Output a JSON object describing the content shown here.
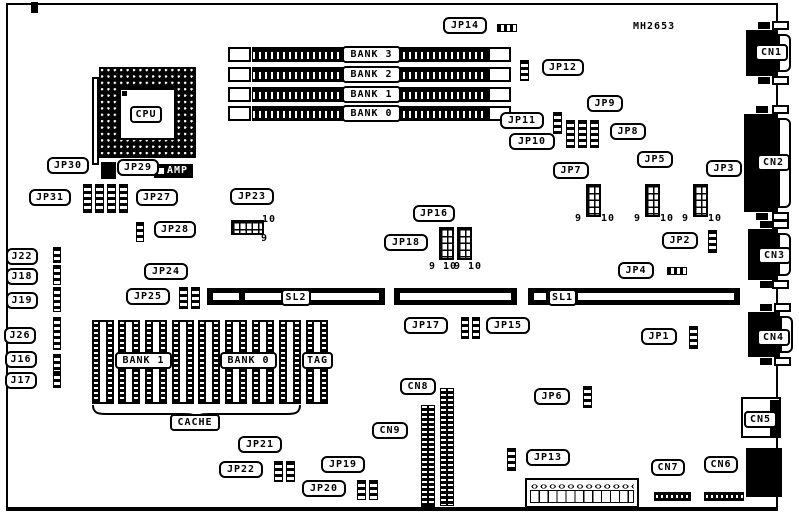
{
  "colors": {
    "ink": "#000000",
    "paper": "#ffffff"
  },
  "board": {
    "x": 6,
    "y": 3,
    "w": 772,
    "h": 508
  },
  "part_label": {
    "text": "MH2653",
    "x": 633,
    "y": 21
  },
  "amp": {
    "text": "AMP",
    "x": 154,
    "y": 164,
    "w": 39,
    "h": 14
  },
  "callouts": [
    {
      "text": "JP14",
      "x": 443,
      "y": 17,
      "w": 44,
      "dir": "right"
    },
    {
      "text": "JP12",
      "x": 542,
      "y": 59,
      "w": 42,
      "dir": "left"
    },
    {
      "text": "JP11",
      "x": 500,
      "y": 112,
      "w": 44,
      "dir": "right"
    },
    {
      "text": "JP9",
      "x": 587,
      "y": 95,
      "w": 36,
      "dir": "down-left"
    },
    {
      "text": "JP10",
      "x": 509,
      "y": 133,
      "w": 46,
      "dir": "right"
    },
    {
      "text": "JP8",
      "x": 610,
      "y": 123,
      "w": 36,
      "dir": "left"
    },
    {
      "text": "JP7",
      "x": 553,
      "y": 162,
      "w": 36,
      "dir": "down-right"
    },
    {
      "text": "JP5",
      "x": 637,
      "y": 151,
      "w": 36,
      "dir": "down"
    },
    {
      "text": "JP3",
      "x": 706,
      "y": 160,
      "w": 36,
      "dir": "down-left"
    },
    {
      "text": "JP2",
      "x": 662,
      "y": 232,
      "w": 36,
      "dir": "right"
    },
    {
      "text": "JP4",
      "x": 618,
      "y": 262,
      "w": 36,
      "dir": "right"
    },
    {
      "text": "JP23",
      "x": 230,
      "y": 188,
      "w": 44,
      "dir": "down"
    },
    {
      "text": "JP16",
      "x": 413,
      "y": 205,
      "w": 42,
      "dir": "down-right"
    },
    {
      "text": "JP18",
      "x": 384,
      "y": 234,
      "w": 44,
      "dir": "right"
    },
    {
      "text": "JP30",
      "x": 47,
      "y": 157,
      "w": 42,
      "dir": "down-right"
    },
    {
      "text": "JP29",
      "x": 117,
      "y": 159,
      "w": 42,
      "dir": "down-left"
    },
    {
      "text": "JP31",
      "x": 29,
      "y": 189,
      "w": 42,
      "dir": "right"
    },
    {
      "text": "JP27",
      "x": 136,
      "y": 189,
      "w": 42,
      "dir": "left"
    },
    {
      "text": "JP28",
      "x": 154,
      "y": 221,
      "w": 42,
      "dir": "left"
    },
    {
      "text": "J22",
      "x": 6,
      "y": 248,
      "w": 32,
      "dir": "right"
    },
    {
      "text": "J18",
      "x": 6,
      "y": 268,
      "w": 32,
      "dir": "right"
    },
    {
      "text": "J19",
      "x": 6,
      "y": 292,
      "w": 32,
      "dir": "right"
    },
    {
      "text": "J26",
      "x": 4,
      "y": 327,
      "w": 32,
      "dir": "right"
    },
    {
      "text": "J16",
      "x": 5,
      "y": 351,
      "w": 32,
      "dir": "right"
    },
    {
      "text": "J17",
      "x": 5,
      "y": 372,
      "w": 32,
      "dir": "right"
    },
    {
      "text": "JP24",
      "x": 144,
      "y": 263,
      "w": 44,
      "dir": "down-right"
    },
    {
      "text": "JP25",
      "x": 126,
      "y": 288,
      "w": 44,
      "dir": "right"
    },
    {
      "text": "JP17",
      "x": 404,
      "y": 317,
      "w": 44,
      "dir": "right"
    },
    {
      "text": "JP15",
      "x": 486,
      "y": 317,
      "w": 44,
      "dir": "left"
    },
    {
      "text": "JP1",
      "x": 641,
      "y": 328,
      "w": 36,
      "dir": "right"
    },
    {
      "text": "JP21",
      "x": 238,
      "y": 436,
      "w": 44,
      "dir": "down-right"
    },
    {
      "text": "JP22",
      "x": 219,
      "y": 461,
      "w": 44,
      "dir": "right"
    },
    {
      "text": "JP19",
      "x": 321,
      "y": 456,
      "w": 44,
      "dir": "down-right"
    },
    {
      "text": "JP20",
      "x": 302,
      "y": 480,
      "w": 44,
      "dir": "right"
    },
    {
      "text": "JP6",
      "x": 534,
      "y": 388,
      "w": 36,
      "dir": "right"
    },
    {
      "text": "JP13",
      "x": 526,
      "y": 449,
      "w": 44,
      "dir": "left"
    },
    {
      "text": "CN8",
      "x": 400,
      "y": 378,
      "w": 36,
      "dir": "down-right"
    },
    {
      "text": "CN9",
      "x": 372,
      "y": 422,
      "w": 36,
      "dir": "right"
    },
    {
      "text": "CN7",
      "x": 651,
      "y": 459,
      "w": 34,
      "dir": "down"
    },
    {
      "text": "CN6",
      "x": 704,
      "y": 456,
      "w": 34,
      "dir": "down"
    }
  ],
  "plates": [
    {
      "text": "CPU",
      "x": 130,
      "y": 106,
      "w": 32
    },
    {
      "text": "BANK 3",
      "x": 342,
      "y": 46,
      "w": 59
    },
    {
      "text": "BANK 2",
      "x": 342,
      "y": 66,
      "w": 59
    },
    {
      "text": "BANK 1",
      "x": 342,
      "y": 86,
      "w": 59
    },
    {
      "text": "BANK 0",
      "x": 342,
      "y": 105,
      "w": 59
    },
    {
      "text": "SL2",
      "x": 281,
      "y": 289,
      "w": 30
    },
    {
      "text": "SL1",
      "x": 548,
      "y": 289,
      "w": 29
    },
    {
      "text": "BANK 1",
      "x": 115,
      "y": 352,
      "w": 57
    },
    {
      "text": "BANK 0",
      "x": 220,
      "y": 352,
      "w": 57
    },
    {
      "text": "TAG",
      "x": 302,
      "y": 352,
      "w": 31
    },
    {
      "text": "CACHE",
      "x": 170,
      "y": 414,
      "w": 50
    },
    {
      "text": "CN1",
      "x": 755,
      "y": 44,
      "w": 33
    },
    {
      "text": "CN2",
      "x": 757,
      "y": 154,
      "w": 33
    },
    {
      "text": "CN3",
      "x": 758,
      "y": 247,
      "w": 33
    },
    {
      "text": "CN4",
      "x": 757,
      "y": 329,
      "w": 33
    },
    {
      "text": "CN5",
      "x": 744,
      "y": 411,
      "w": 33
    }
  ],
  "pin_labels": [
    {
      "text": "10",
      "x": 262,
      "y": 214
    },
    {
      "text": "9",
      "x": 261,
      "y": 233
    },
    {
      "text": "9 10",
      "x": 429,
      "y": 261
    },
    {
      "text": "9 10",
      "x": 454,
      "y": 261
    },
    {
      "text": "9",
      "x": 575,
      "y": 213
    },
    {
      "text": "10",
      "x": 601,
      "y": 213
    },
    {
      "text": "9",
      "x": 634,
      "y": 213
    },
    {
      "text": "10",
      "x": 660,
      "y": 213
    },
    {
      "text": "9",
      "x": 682,
      "y": 213
    },
    {
      "text": "10",
      "x": 708,
      "y": 213
    }
  ],
  "jumpers": [
    {
      "id": "jp14-jumper",
      "x": 497,
      "y": 24,
      "w": 20,
      "h": 8,
      "o": "h"
    },
    {
      "id": "jp12-jumper",
      "x": 520,
      "y": 60,
      "w": 9,
      "h": 21,
      "o": "v"
    },
    {
      "id": "jp11-jumper",
      "x": 553,
      "y": 112,
      "w": 9,
      "h": 22,
      "o": "v"
    },
    {
      "id": "jp10-jumper",
      "x": 566,
      "y": 120,
      "w": 9,
      "h": 28,
      "o": "v"
    },
    {
      "id": "jp9-jumper",
      "x": 578,
      "y": 120,
      "w": 9,
      "h": 28,
      "o": "v"
    },
    {
      "id": "jp8-jumper",
      "x": 590,
      "y": 120,
      "w": 9,
      "h": 28,
      "o": "v"
    },
    {
      "id": "jp2-jumper",
      "x": 708,
      "y": 230,
      "w": 9,
      "h": 23,
      "o": "v"
    },
    {
      "id": "jp4-jumper",
      "x": 667,
      "y": 267,
      "w": 20,
      "h": 8,
      "o": "h"
    },
    {
      "id": "jp31-jumper",
      "x": 83,
      "y": 184,
      "w": 9,
      "h": 29,
      "o": "v"
    },
    {
      "id": "jp30-jumper",
      "x": 95,
      "y": 184,
      "w": 9,
      "h": 29,
      "o": "v"
    },
    {
      "id": "jp29-jumper",
      "x": 107,
      "y": 184,
      "w": 9,
      "h": 29,
      "o": "v"
    },
    {
      "id": "jp27-jumper",
      "x": 119,
      "y": 184,
      "w": 9,
      "h": 29,
      "o": "v"
    },
    {
      "id": "jp28-jumper",
      "x": 136,
      "y": 222,
      "w": 8,
      "h": 20,
      "o": "v"
    },
    {
      "id": "j22-jumper",
      "x": 53,
      "y": 247,
      "w": 8,
      "h": 16,
      "o": "v"
    },
    {
      "id": "j18-jumper",
      "x": 53,
      "y": 265,
      "w": 8,
      "h": 20,
      "o": "v"
    },
    {
      "id": "j19-jumper",
      "x": 53,
      "y": 287,
      "w": 8,
      "h": 25,
      "o": "v"
    },
    {
      "id": "j26-jumper",
      "x": 53,
      "y": 317,
      "w": 8,
      "h": 33,
      "o": "v"
    },
    {
      "id": "j16-jumper",
      "x": 53,
      "y": 354,
      "w": 8,
      "h": 18,
      "o": "v"
    },
    {
      "id": "j17-jumper",
      "x": 53,
      "y": 372,
      "w": 8,
      "h": 16,
      "o": "v"
    },
    {
      "id": "jp25-jumper",
      "x": 179,
      "y": 287,
      "w": 9,
      "h": 22,
      "o": "v"
    },
    {
      "id": "jp24-jumper",
      "x": 191,
      "y": 287,
      "w": 9,
      "h": 22,
      "o": "v"
    },
    {
      "id": "jp17-jumper",
      "x": 461,
      "y": 317,
      "w": 8,
      "h": 22,
      "o": "v"
    },
    {
      "id": "jp15-jumper",
      "x": 472,
      "y": 317,
      "w": 8,
      "h": 22,
      "o": "v"
    },
    {
      "id": "jp1-jumper",
      "x": 689,
      "y": 326,
      "w": 9,
      "h": 23,
      "o": "v"
    },
    {
      "id": "jp22-jumper",
      "x": 274,
      "y": 461,
      "w": 9,
      "h": 21,
      "o": "v"
    },
    {
      "id": "jp21-jumper",
      "x": 286,
      "y": 461,
      "w": 9,
      "h": 21,
      "o": "v"
    },
    {
      "id": "jp20-jumper",
      "x": 357,
      "y": 480,
      "w": 9,
      "h": 20,
      "o": "v"
    },
    {
      "id": "jp19-jumper",
      "x": 369,
      "y": 480,
      "w": 9,
      "h": 20,
      "o": "v"
    },
    {
      "id": "jp6-jumper",
      "x": 583,
      "y": 386,
      "w": 9,
      "h": 22,
      "o": "v"
    },
    {
      "id": "jp13-jumper",
      "x": 507,
      "y": 448,
      "w": 9,
      "h": 23,
      "o": "v"
    }
  ],
  "pin_headers": [
    {
      "id": "jp7-header",
      "x": 586,
      "y": 184,
      "w": 15,
      "h": 33
    },
    {
      "id": "jp5-header",
      "x": 645,
      "y": 184,
      "w": 15,
      "h": 33
    },
    {
      "id": "jp3-header",
      "x": 693,
      "y": 184,
      "w": 15,
      "h": 33
    },
    {
      "id": "jp18-header",
      "x": 439,
      "y": 227,
      "w": 15,
      "h": 33
    },
    {
      "id": "jp16-header",
      "x": 457,
      "y": 227,
      "w": 15,
      "h": 33
    },
    {
      "id": "jp23-header",
      "x": 231,
      "y": 220,
      "w": 33,
      "h": 15
    }
  ],
  "tall_headers": [
    {
      "id": "cn8-connector",
      "x": 440,
      "y": 388,
      "w": 14,
      "h": 118
    },
    {
      "id": "cn9-connector",
      "x": 421,
      "y": 405,
      "w": 14,
      "h": 102
    }
  ],
  "simm": {
    "ys": [
      47,
      67,
      87,
      106
    ],
    "h": 15,
    "clip_l": 228,
    "bar_x": 252,
    "bar_w": 236,
    "clip_r": 488,
    "clip_w": 23
  },
  "slots": [
    {
      "id": "slot-sl2",
      "x": 207,
      "y": 288,
      "w": 178,
      "h": 17,
      "segs": [
        [
          6,
          26
        ],
        [
          38,
          36
        ],
        [
          104,
          68
        ]
      ]
    },
    {
      "id": "slot-mid",
      "x": 394,
      "y": 288,
      "w": 123,
      "h": 17,
      "segs": [
        [
          6,
          111
        ]
      ]
    },
    {
      "id": "slot-sl1",
      "x": 528,
      "y": 288,
      "w": 212,
      "h": 17,
      "segs": [
        [
          6,
          12
        ],
        [
          50,
          156
        ]
      ]
    }
  ],
  "cache": {
    "chip_xs": [
      92,
      118,
      145,
      172,
      198,
      225,
      252,
      279
    ],
    "tag_x": 306,
    "y": 320,
    "w": 22,
    "h": 84,
    "brace": {
      "x": 92,
      "y": 404,
      "w": 209,
      "h": 14
    }
  },
  "cpu": {
    "socket": {
      "x": 99,
      "y": 67,
      "w": 97,
      "h": 91
    },
    "die": {
      "x": 119,
      "y": 88,
      "w": 57,
      "h": 52
    },
    "lever": {
      "x": 92,
      "y": 77,
      "w": 7,
      "h": 88
    },
    "mark": {
      "x": 122,
      "y": 91,
      "w": 5,
      "h": 5
    },
    "ic": {
      "x": 101,
      "y": 162,
      "w": 15,
      "h": 17
    }
  },
  "power_connector": {
    "x": 525,
    "y": 478,
    "w": 114,
    "h": 30
  },
  "dot_strips": [
    {
      "id": "cn7-strip",
      "x": 654,
      "y": 492,
      "w": 37,
      "h": 9
    },
    {
      "id": "cn6-strip",
      "x": 704,
      "y": 492,
      "w": 40,
      "h": 9
    }
  ],
  "dsubs": [
    {
      "id": "cn1-port",
      "x": 746,
      "y": 30,
      "w": 32,
      "h": 46
    },
    {
      "id": "cn2-port",
      "x": 744,
      "y": 114,
      "w": 34,
      "h": 98
    },
    {
      "id": "cn3-port",
      "x": 748,
      "y": 229,
      "w": 30,
      "h": 51
    },
    {
      "id": "cn4-port",
      "x": 748,
      "y": 312,
      "w": 32,
      "h": 45
    }
  ],
  "cn5_connector": {
    "box": {
      "x": 741,
      "y": 397,
      "w": 40,
      "h": 41
    },
    "bar": {
      "x": 770,
      "y": 400,
      "w": 11,
      "h": 36
    }
  },
  "corner_connector": {
    "x": 746,
    "y": 448,
    "w": 36,
    "h": 49
  },
  "top_stub": {
    "x": 31,
    "y": 2,
    "w": 7,
    "h": 11
  }
}
